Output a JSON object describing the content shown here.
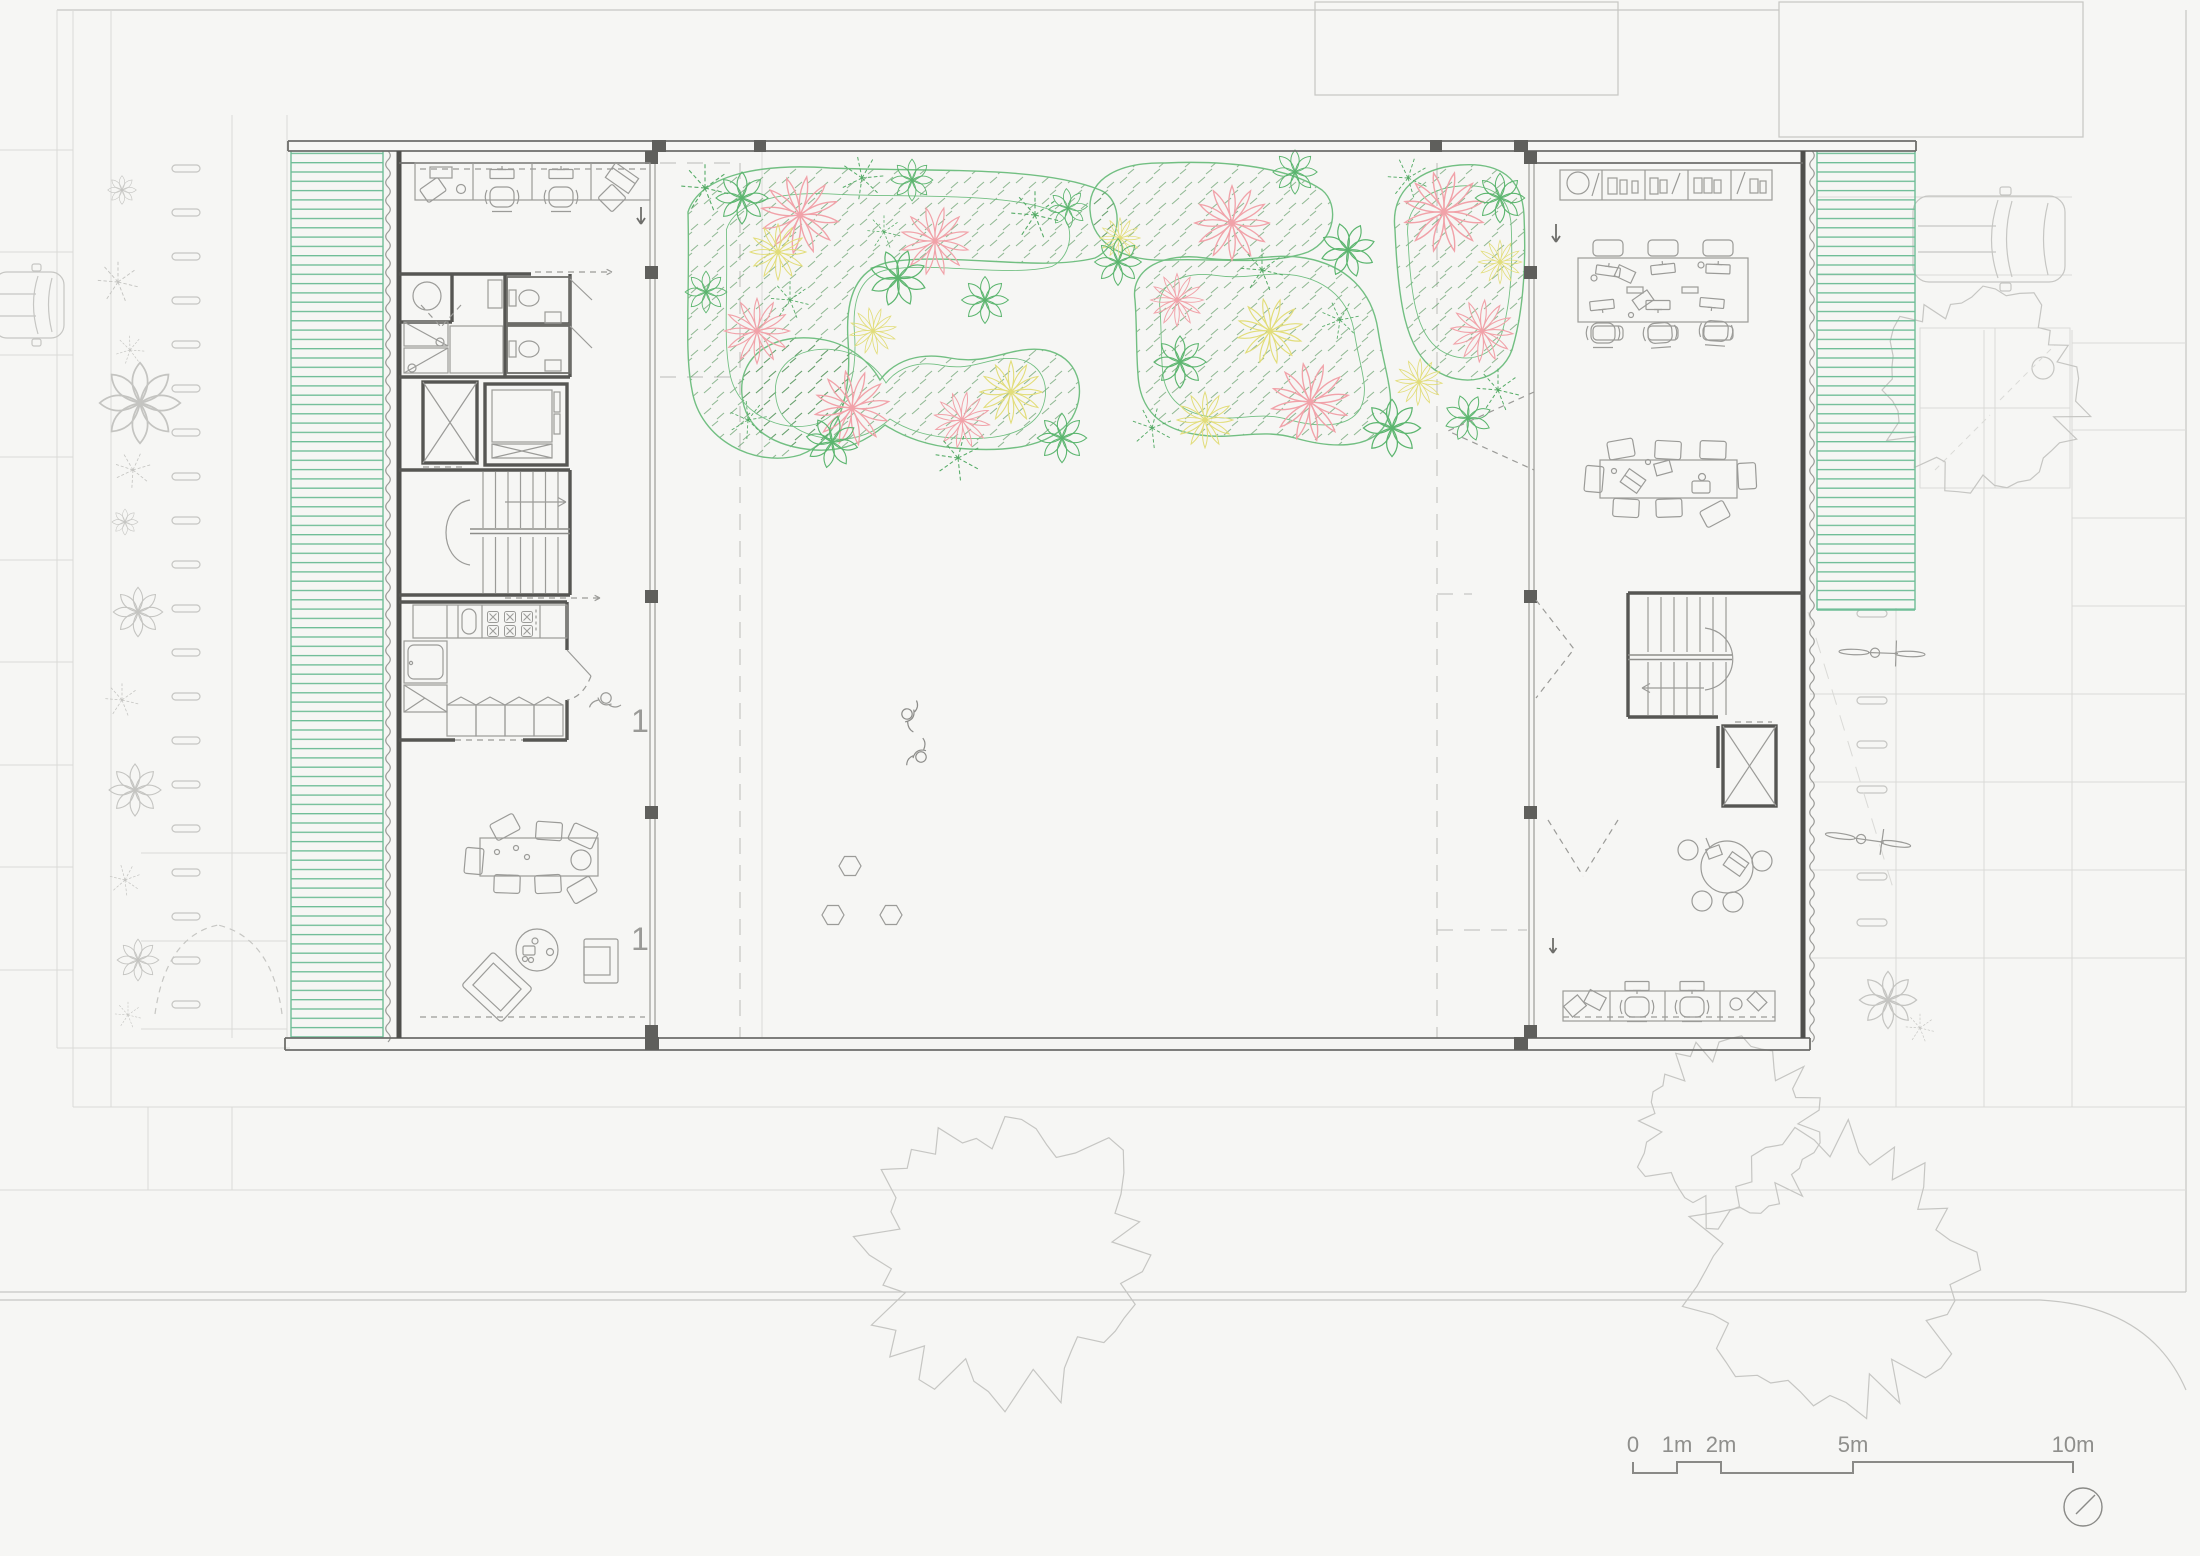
{
  "scale_bar": {
    "labels": [
      "0",
      "1m",
      "2m",
      "5m",
      "10m"
    ]
  },
  "rooms": {
    "kitchen_label": "1",
    "lounge_label": "1"
  },
  "colors": {
    "louver_green": "#6fbd97",
    "garden_green": "#72bf82",
    "hatch_green": "#4f9155",
    "flower_pink": "#f1a2a9",
    "flower_yellow": "#e2dd7a",
    "leaf_green": "#5bb56e",
    "fern_green": "#55ab66"
  }
}
